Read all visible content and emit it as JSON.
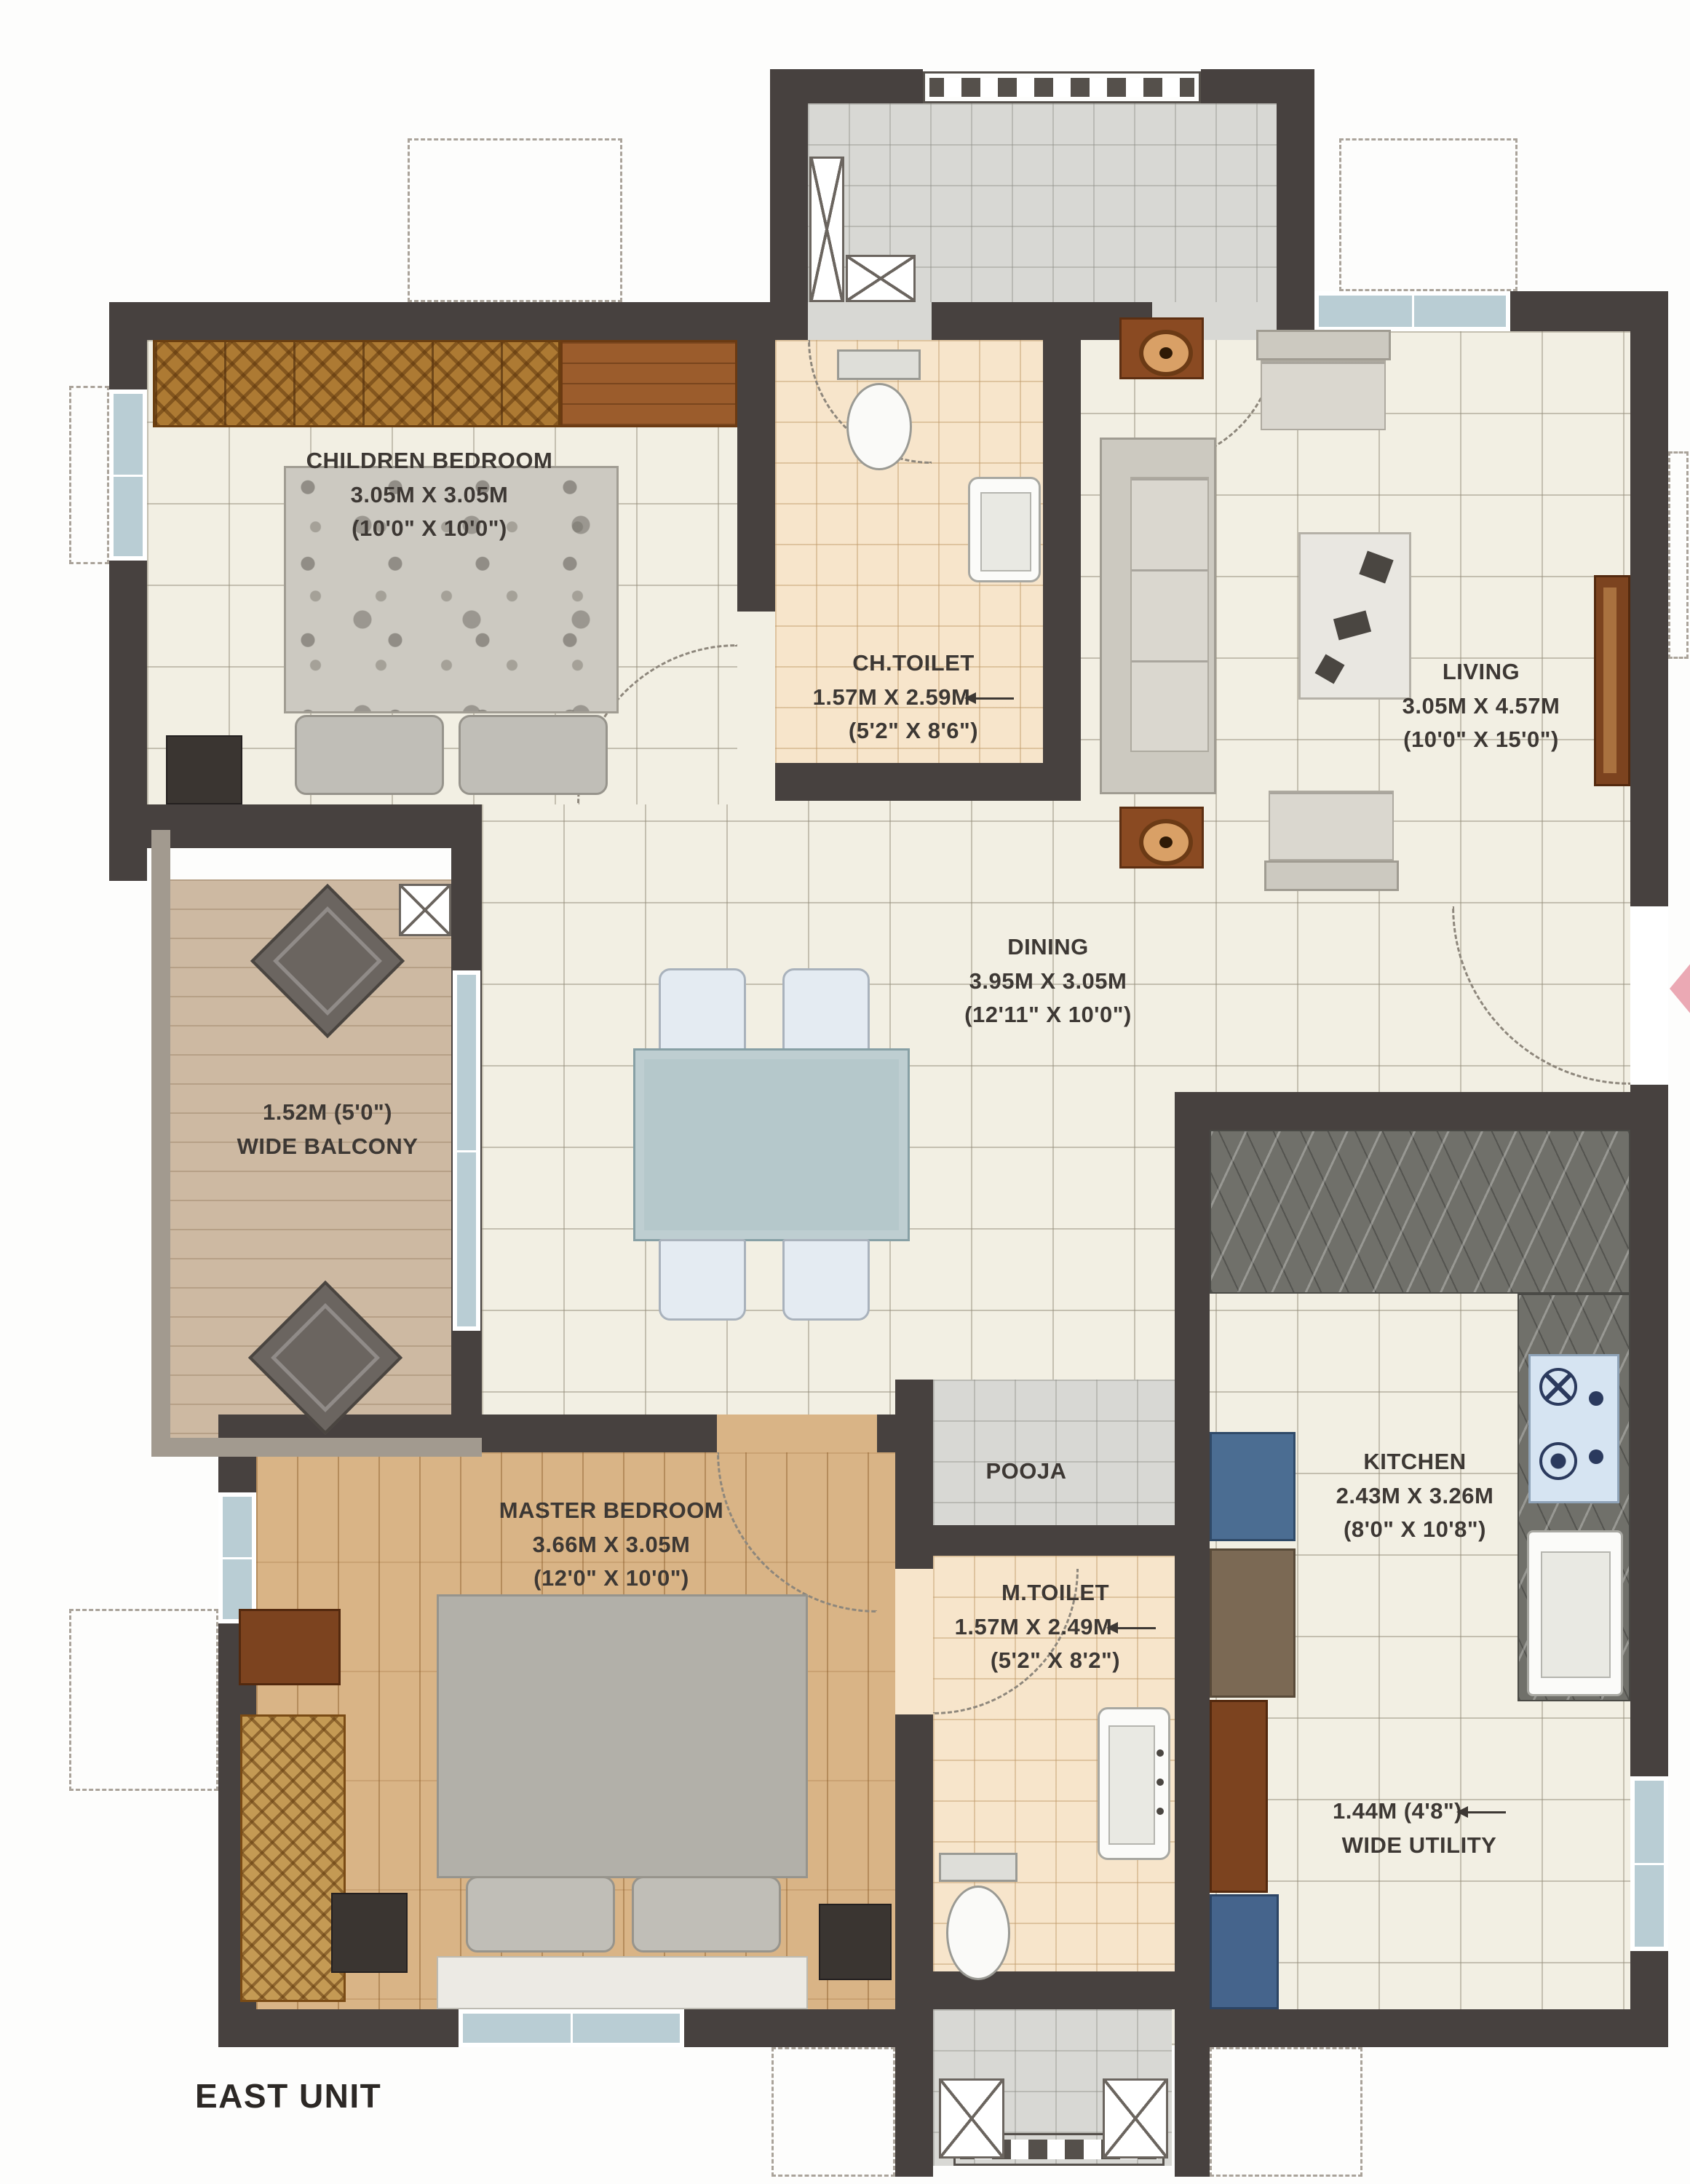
{
  "title": "EAST UNIT",
  "colors": {
    "wall": "#47413f",
    "window_blue": "#b9cdd4",
    "floor_tile": "#f2efe3",
    "floor_toilet": "#f7e5cb",
    "floor_wood": "#d9b486",
    "floor_balcony": "#cdb9a2",
    "floor_lobby": "#d8d8d4",
    "counter_marble": "#70706a",
    "accent_blue": "#4b6d92",
    "entry_arrow_pink": "#eba9b4"
  },
  "rooms": {
    "children_bedroom": {
      "name": "CHILDREN BEDROOM",
      "size_m": "3.05M X 3.05M",
      "size_ft": "(10'0\" X 10'0\")"
    },
    "ch_toilet": {
      "name": "CH.TOILET",
      "size_m": "1.57M X 2.59M",
      "size_ft": "(5'2\" X 8'6\")"
    },
    "living": {
      "name": "LIVING",
      "size_m": "3.05M X 4.57M",
      "size_ft": "(10'0\" X 15'0\")"
    },
    "dining": {
      "name": "DINING",
      "size_m": "3.95M X 3.05M",
      "size_ft": "(12'11\" X 10'0\")"
    },
    "balcony": {
      "line1": "1.52M (5'0\")",
      "line2": "WIDE BALCONY"
    },
    "master_bedroom": {
      "name": "MASTER BEDROOM",
      "size_m": "3.66M X 3.05M",
      "size_ft": "(12'0\" X 10'0\")"
    },
    "pooja": {
      "name": "POOJA"
    },
    "m_toilet": {
      "name": "M.TOILET",
      "size_m": "1.57M X 2.49M",
      "size_ft": "(5'2\" X 8'2\")"
    },
    "kitchen": {
      "name": "KITCHEN",
      "size_m": "2.43M X 3.26M",
      "size_ft": "(8'0\" X 10'8\")"
    },
    "utility": {
      "line1": "1.44M (4'8\")",
      "line2": "WIDE UTILITY"
    }
  }
}
